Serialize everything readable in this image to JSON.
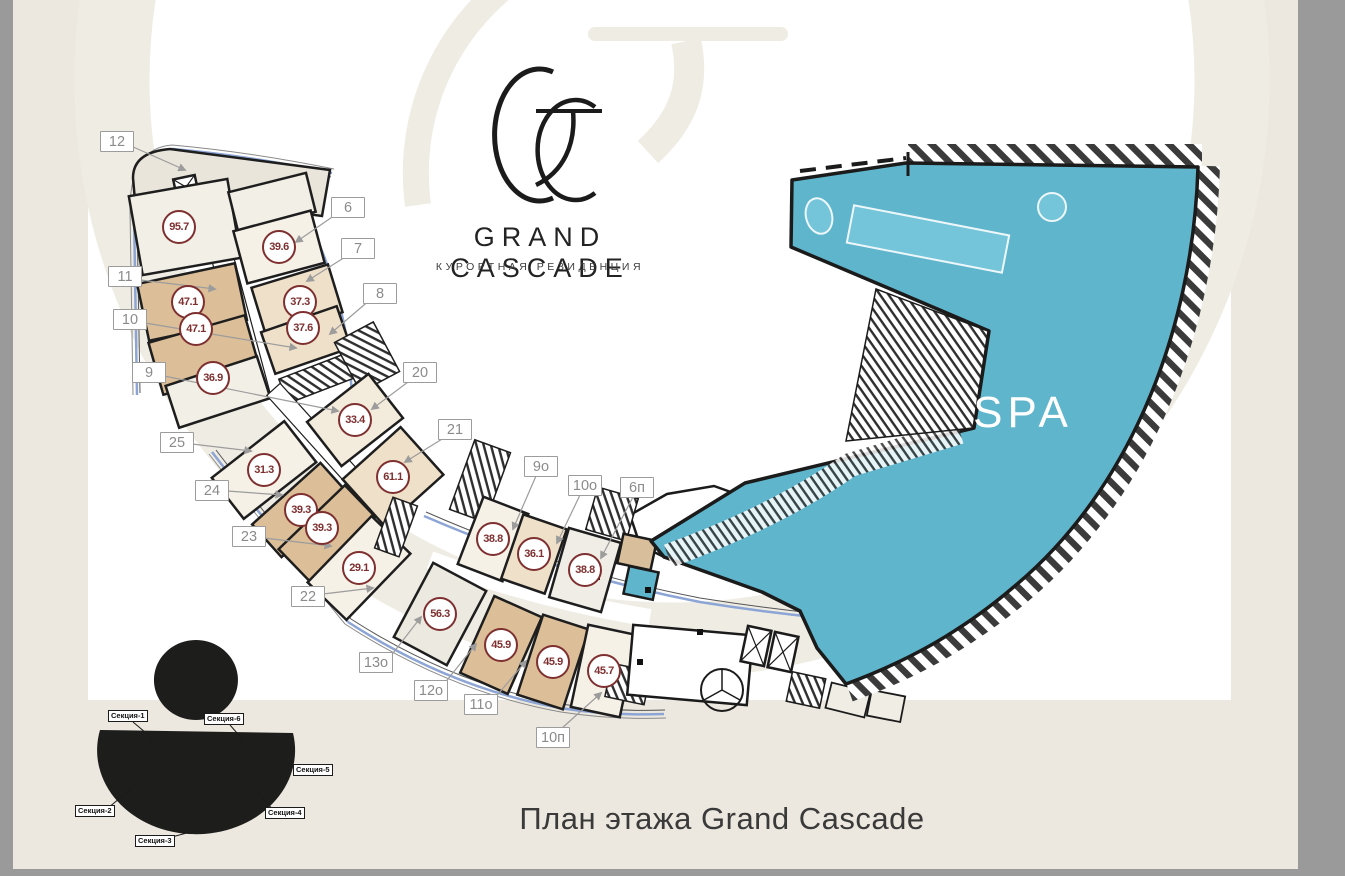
{
  "logo": {
    "title": "GRAND CASCADE",
    "subtitle": "КУРОРТНАЯ РЕЗИДЕНЦИЯ"
  },
  "plan": {
    "spa_label": "SPA",
    "callouts": [
      {
        "text": "12"
      },
      {
        "text": "6"
      },
      {
        "text": "7"
      },
      {
        "text": "8"
      },
      {
        "text": "11"
      },
      {
        "text": "10"
      },
      {
        "text": "9"
      },
      {
        "text": "20"
      },
      {
        "text": "21"
      },
      {
        "text": "25"
      },
      {
        "text": "24"
      },
      {
        "text": "23"
      },
      {
        "text": "22"
      },
      {
        "text": "9о"
      },
      {
        "text": "10о"
      },
      {
        "text": "6п"
      },
      {
        "text": "13о"
      },
      {
        "text": "12о"
      },
      {
        "text": "11о"
      },
      {
        "text": "10п"
      }
    ],
    "areas": [
      "95.7",
      "47.1",
      "47.1",
      "36.9",
      "39.6",
      "37.3",
      "37.6",
      "33.4",
      "61.1",
      "31.3",
      "39.3",
      "39.3",
      "29.1",
      "38.8",
      "36.1",
      "38.8",
      "56.3",
      "45.9",
      "45.9",
      "45.7"
    ]
  },
  "minimap": {
    "sections": [
      "Секция-1",
      "Секция-2",
      "Секция-3",
      "Секция-4",
      "Секция-5",
      "Секция-6"
    ]
  },
  "footer": {
    "title": "План этажа Grand Cascade"
  },
  "colors": {
    "spa_teal": "#5FB5CC",
    "pool_teal": "#74C5DA",
    "area_maroon": "#7E3030",
    "background_beige": "#ECE8DF",
    "frame_gray": "#9A9A9A",
    "glazing_blue": "#8CA5D5"
  }
}
